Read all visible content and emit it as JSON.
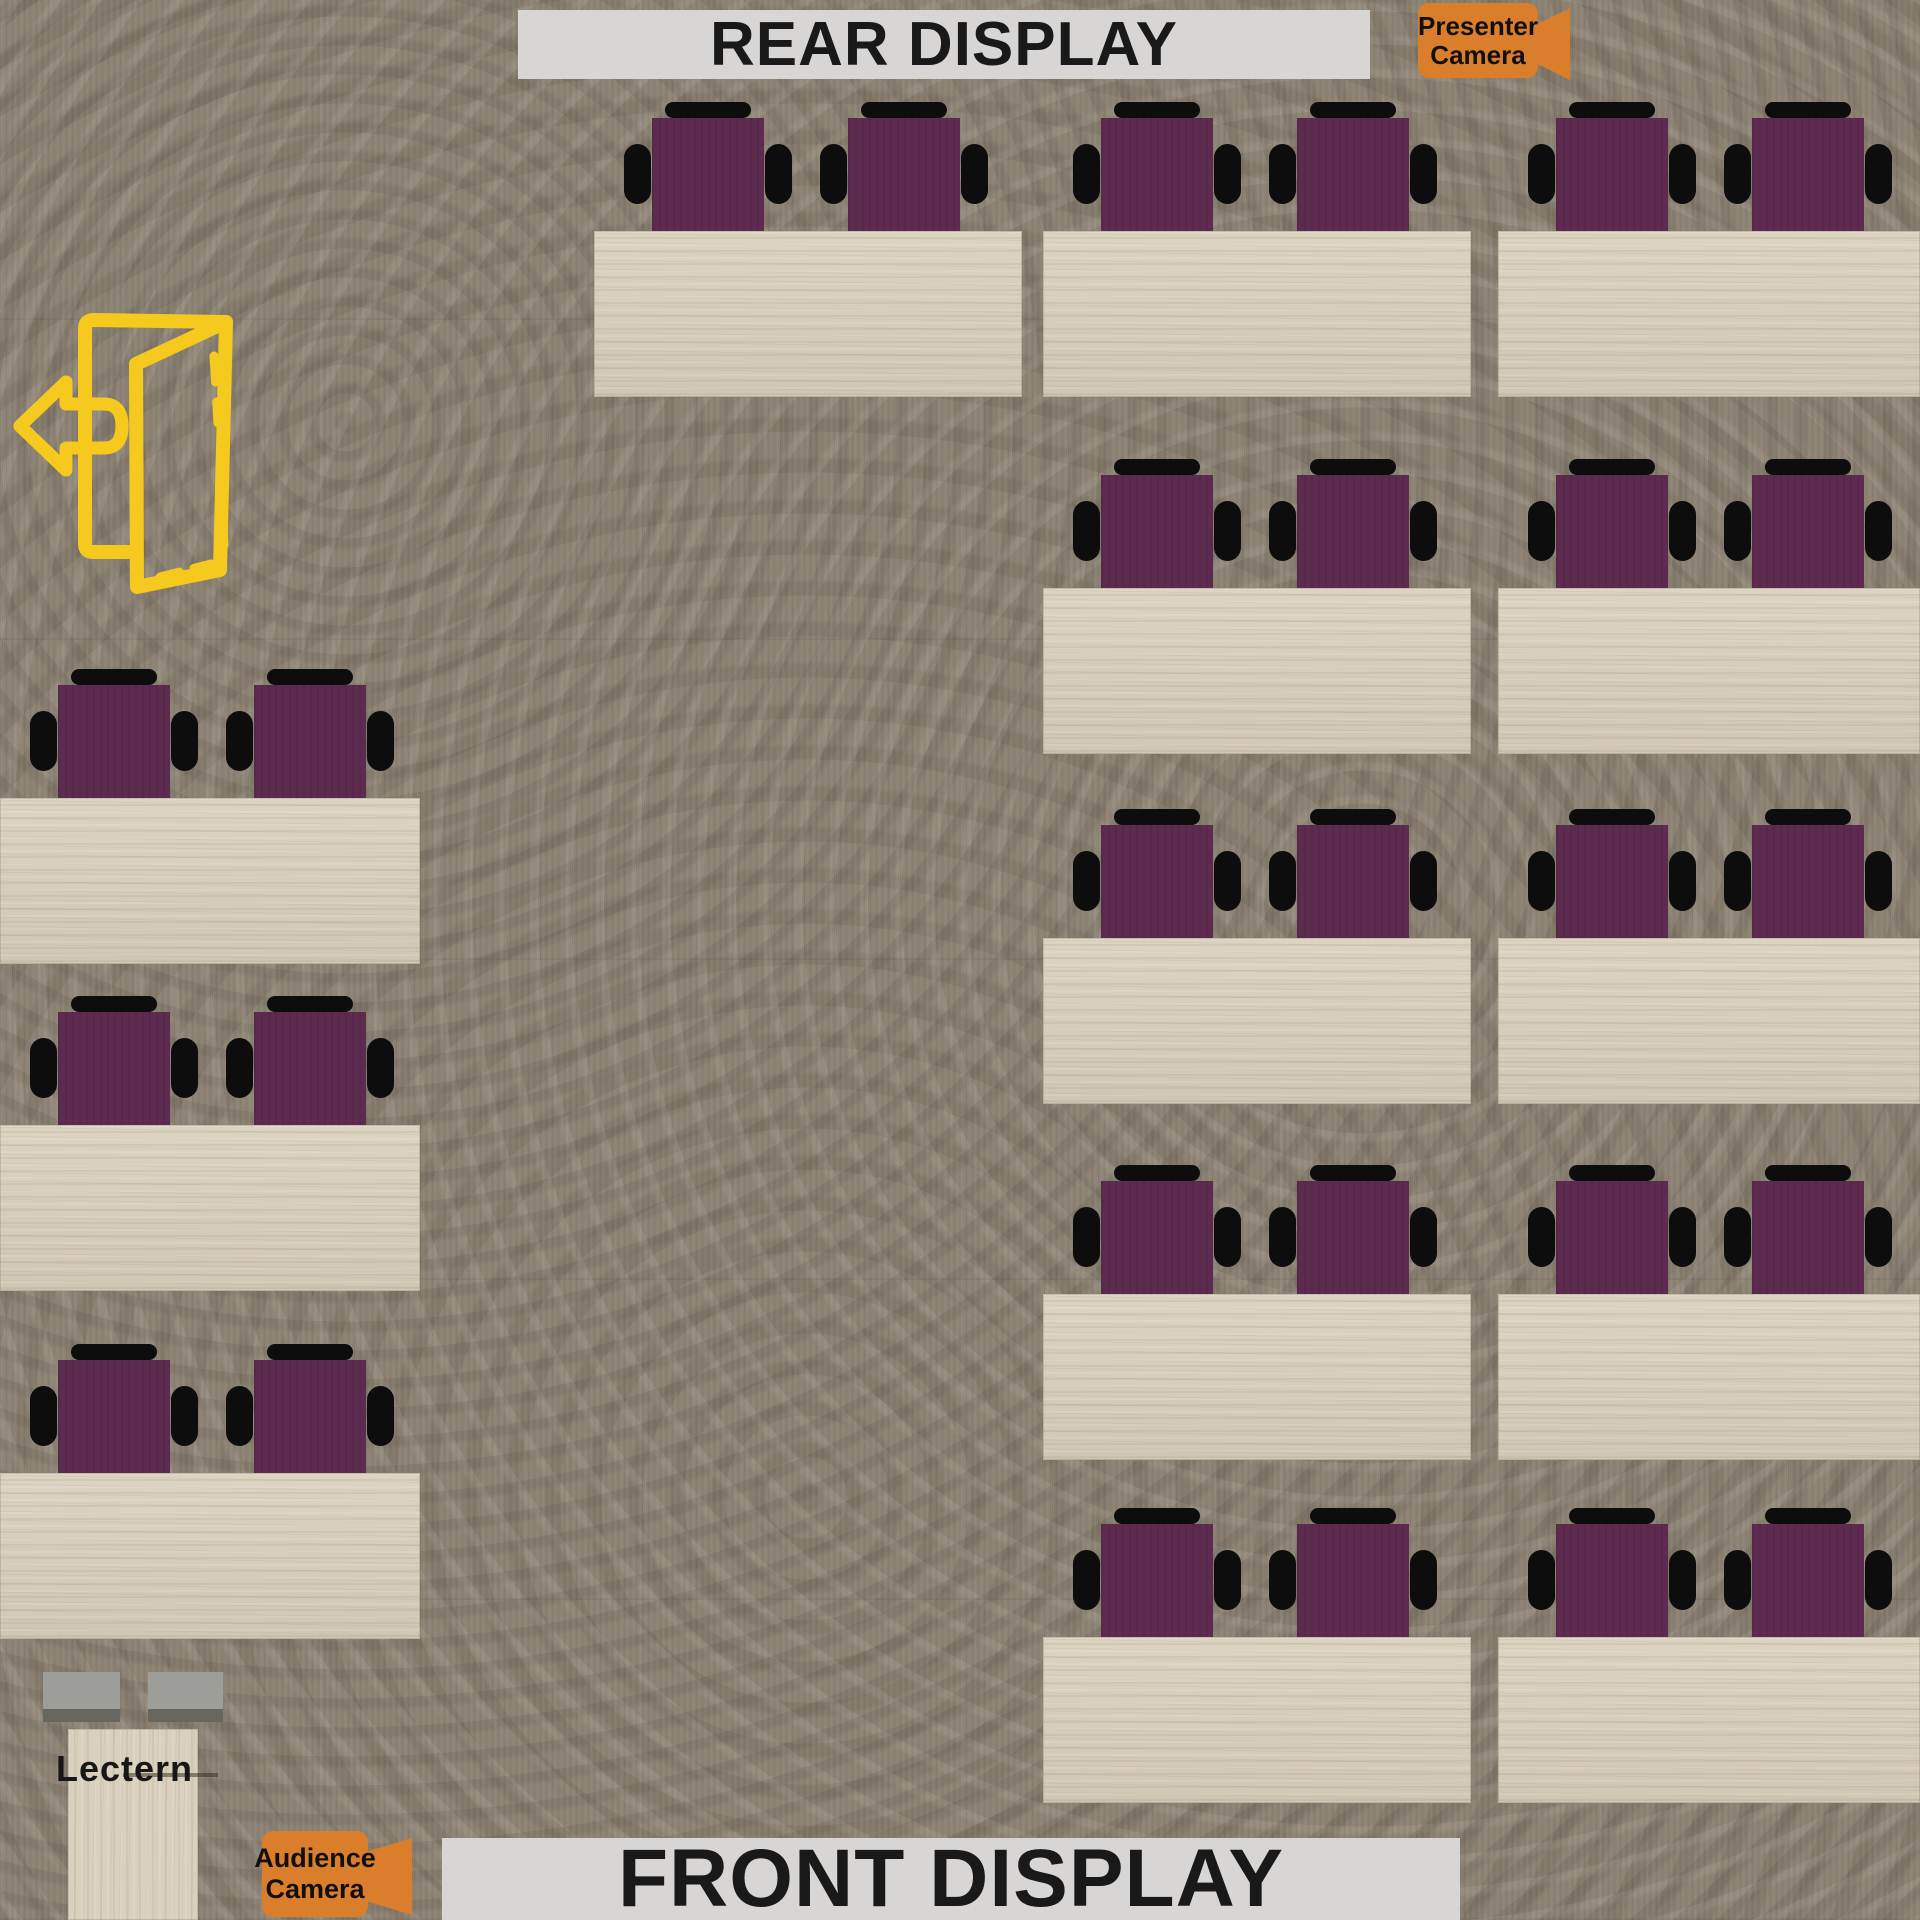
{
  "title": "Training room floor plan",
  "labels": {
    "rear_display": "REAR DISPLAY",
    "front_display": "FRONT DISPLAY",
    "presenter_camera_line1": "Presenter",
    "presenter_camera_line2": "Camera",
    "audience_camera_line1": "Audience",
    "audience_camera_line2": "Camera",
    "lectern": "Lectern"
  },
  "colors": {
    "carpet": "#8c8374",
    "table_wood": "#d9d1bd",
    "chair_seat_purple": "#5e2b50",
    "chair_frame_black": "#0d0d0d",
    "display_banner_bg": "#d7d6d4",
    "display_text": "#191919",
    "camera_label_orange": "#db7e2c",
    "exit_door_yellow": "#f5c91d",
    "lectern_monitor_gray": "#9d9d99",
    "lectern_monitor_dark": "#67675f"
  },
  "floorplan": {
    "room_px": {
      "width": 1920,
      "height": 1920
    },
    "chair": {
      "seat_w": 112,
      "seat_h": 113,
      "back_w": 86,
      "back_h": 16,
      "arm_w": 27,
      "arm_h": 60
    },
    "table_default": {
      "w": 428,
      "h": 166
    },
    "chair_offsets": [
      58,
      254
    ],
    "seats_per_table": 2,
    "table_count": 14,
    "tables": [
      {
        "id": "left-1",
        "x": 0,
        "y": 798,
        "w": 420
      },
      {
        "id": "left-2",
        "x": 0,
        "y": 1125,
        "w": 420
      },
      {
        "id": "left-3",
        "x": 0,
        "y": 1473,
        "w": 420
      },
      {
        "id": "center-1",
        "x": 594,
        "y": 231
      },
      {
        "id": "right-inner-1",
        "x": 1043,
        "y": 231
      },
      {
        "id": "right-outer-1",
        "x": 1498,
        "y": 231,
        "w": 422
      },
      {
        "id": "right-inner-2",
        "x": 1043,
        "y": 588
      },
      {
        "id": "right-outer-2",
        "x": 1498,
        "y": 588,
        "w": 422
      },
      {
        "id": "right-inner-3",
        "x": 1043,
        "y": 938
      },
      {
        "id": "right-outer-3",
        "x": 1498,
        "y": 938,
        "w": 422
      },
      {
        "id": "right-inner-4",
        "x": 1043,
        "y": 1294
      },
      {
        "id": "right-outer-4",
        "x": 1498,
        "y": 1294,
        "w": 422
      },
      {
        "id": "right-inner-5",
        "x": 1043,
        "y": 1637
      },
      {
        "id": "right-outer-5",
        "x": 1498,
        "y": 1637,
        "w": 422
      }
    ]
  }
}
